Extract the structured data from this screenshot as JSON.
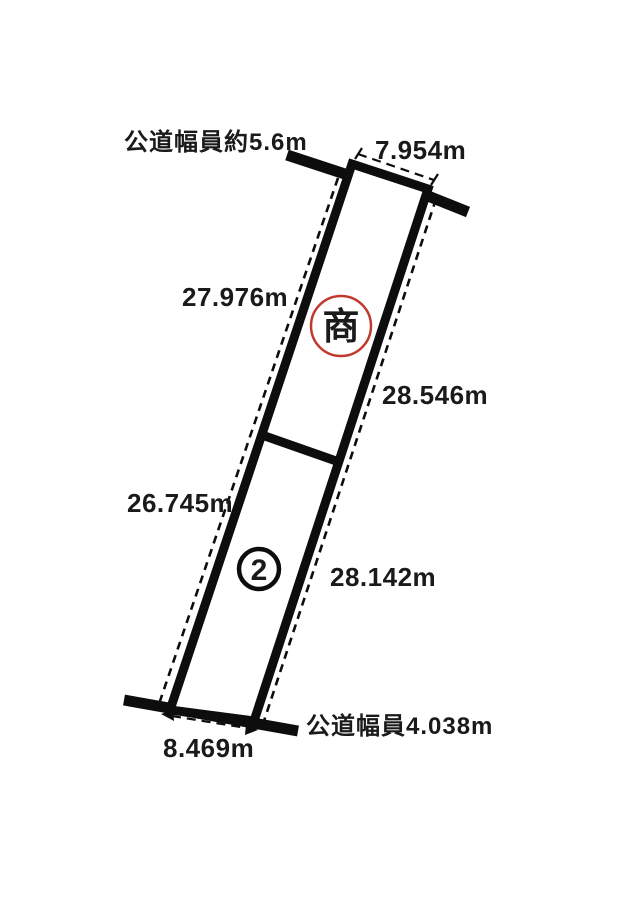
{
  "page": {
    "background": "#ffffff",
    "line_color": "#0d0d0d",
    "text_color": "#1a1a1a",
    "accent_color": "#c03a2e"
  },
  "diagram": {
    "kind": "land-plot-survey-sketch",
    "roads": {
      "top_label": "公道幅員約5.6m",
      "bottom_label": "公道幅員4.038m"
    },
    "parcel": {
      "top_frontage": "7.954m",
      "bottom_frontage": "8.469m",
      "upper_section": {
        "zoning_mark": "商",
        "left_side": "27.976m",
        "right_side": "28.546m"
      },
      "lower_section": {
        "plot_number": "2",
        "left_side": "26.745m",
        "right_side": "28.142m"
      }
    }
  }
}
